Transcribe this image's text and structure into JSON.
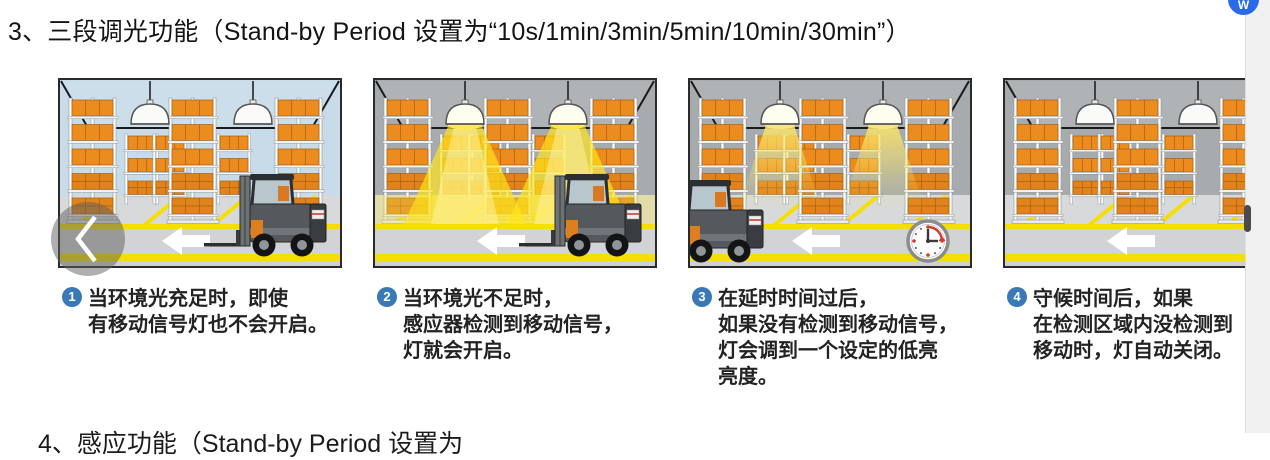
{
  "header": {
    "section_title": "3、三段调光功能（Stand-by Period 设置为“10s/1min/3min/5min/10min/30min”）"
  },
  "floating_icon": {
    "label": "W"
  },
  "carousel": {
    "prev_symbol": "previous"
  },
  "panels": [
    {
      "wall": "#c8dbe9",
      "lights": "off",
      "forklift": "right",
      "clock": false,
      "caption_num": "1",
      "caption": "当环境光充足时，即使\n有移动信号灯也不会开启。"
    },
    {
      "wall": "#a7abae",
      "lights": "bright",
      "forklift": "right",
      "clock": false,
      "caption_num": "2",
      "caption": "当环境光不足时，\n感应器检测到移动信号，\n灯就会开启。"
    },
    {
      "wall": "#a7abae",
      "lights": "dim",
      "forklift": "left-exit",
      "clock": true,
      "caption_num": "3",
      "caption": "在延时时间过后，\n如果没有检测到移动信号，\n灯会调到一个设定的低亮\n亮度。"
    },
    {
      "wall": "#a7abae",
      "lights": "off",
      "forklift": "none",
      "clock": false,
      "caption_num": "4",
      "caption": "守候时间后，如果\n在检测区域内没检测到\n移动时，灯自动关闭。"
    }
  ],
  "footer": {
    "clipped_next_heading": "4、感应功能（Stand-by Period 设置为"
  },
  "colors": {
    "badge_blue": "#3a79b8",
    "icon_blue": "#2a6ae8",
    "floor_yellow": "#f6df00",
    "box_orange": "#ec8b1e",
    "box_orange_dark": "#a65f10",
    "light_yellow": "#ffe41a",
    "floor_gray": "#d8d9da",
    "walkway_gray": "#d2d3d4"
  }
}
